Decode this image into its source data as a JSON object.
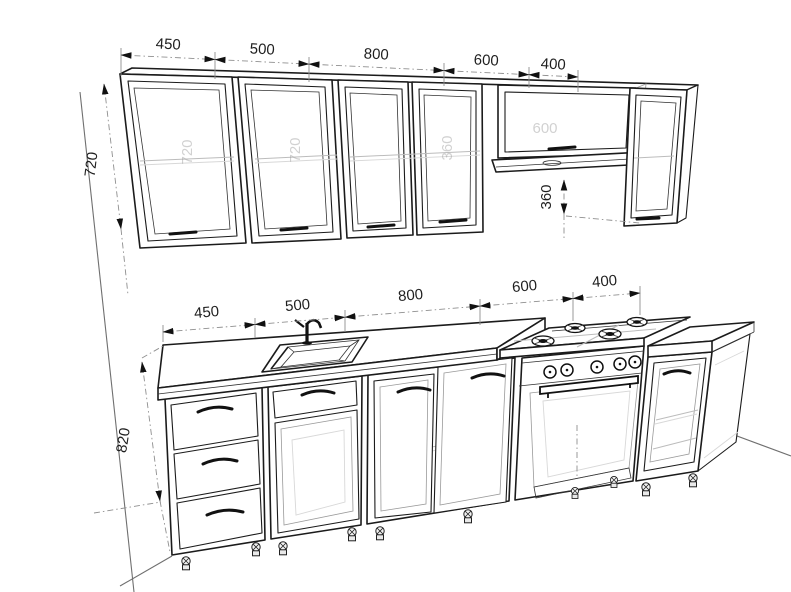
{
  "meta": {
    "title": "Kitchen cabinet set — dimensioned isometric drawing"
  },
  "colors": {
    "line": "#1b1b1b",
    "dim_line": "#8f8f8f",
    "faint": "#bcbcbc",
    "text": "#1f1f1f",
    "watermark": "#9a9a9a",
    "background": "#ffffff"
  },
  "dimensions": {
    "upper_widths": [
      "450",
      "500",
      "800",
      "600",
      "400"
    ],
    "upper_height": "720",
    "hood_offset": "360",
    "lower_widths": [
      "450",
      "500",
      "800",
      "600",
      "400"
    ],
    "lower_height": "820"
  },
  "watermarks": {
    "upper_cab_450": "720",
    "upper_cab_500": "720",
    "upper_cab_800": "360",
    "hood_cab_600": "600"
  }
}
